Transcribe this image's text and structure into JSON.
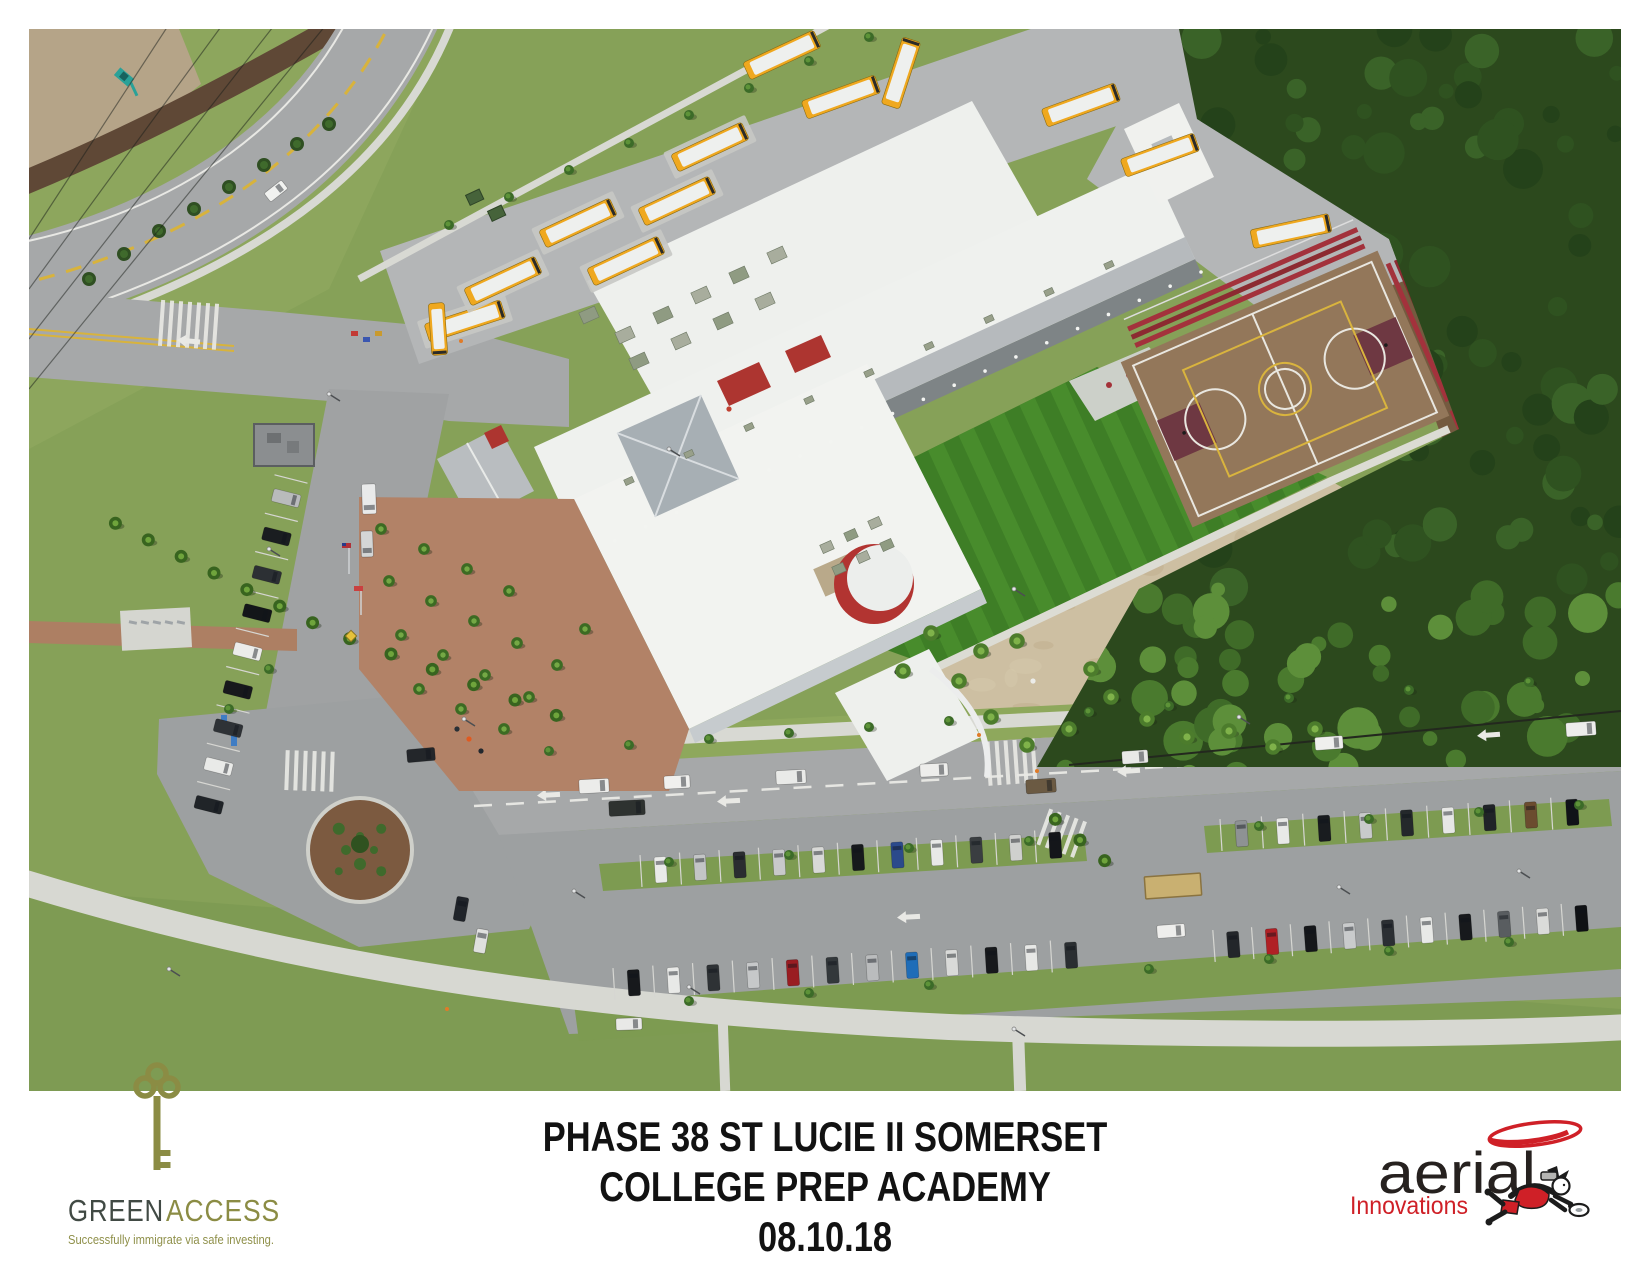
{
  "caption": {
    "line1": "PHASE 38 ST LUCIE II SOMERSET",
    "line2": "COLLEGE PREP ACADEMY",
    "line3": "08.10.18"
  },
  "logos": {
    "greenaccess": {
      "brand_green": "GREEN",
      "brand_access": "ACCESS",
      "tagline": "Successfully immigrate via safe investing.",
      "key_icon": "key-icon",
      "color_dark": "#414a44",
      "color_olive": "#8b8c44",
      "color_tagline": "#8f904a"
    },
    "aerial_innovations": {
      "name": "aerial",
      "sub": "Innovations",
      "swoosh_icon": "swoosh-icon",
      "figure_icon": "flying-photographer-icon",
      "color_red": "#cf2027",
      "color_black": "#26211f"
    }
  },
  "scene": {
    "description": "aerial photograph of school campus with bus loop, buildings, turf field, basketball court, forest and parking lots",
    "colors": {
      "grass": "#86a158",
      "grassLight": "#93ac62",
      "grassDark": "#7a9750",
      "road": "#a6a8a9",
      "lot": "#9da0a1",
      "loop": "#b4b6b7",
      "concrete": "#d8d9d3",
      "sand": "#cdbfa2",
      "dirt": "#8a6f4c",
      "mulch": "#5f4836",
      "forest": "#2c491d",
      "turf": "#3e7e26",
      "turfStripe": "#4a8e2e",
      "court": "#93775a",
      "courtKey": "#6e3842",
      "bleacher": "#a3323c",
      "roofWhite": "#eff1ee",
      "roofGray": "#b6babd",
      "wall": "#c6cbce",
      "shadow": "#7e8486",
      "red": "#ad3530",
      "busYellow": "#efa81f",
      "brick": "#b28267",
      "pond": "#161f12"
    },
    "buses": [
      [
        436,
        292,
        -18,
        80,
        1
      ],
      [
        474,
        252,
        -25,
        78,
        1
      ],
      [
        549,
        194,
        -25,
        78,
        1
      ],
      [
        597,
        232,
        -25,
        78,
        1
      ],
      [
        648,
        172,
        -25,
        78,
        1
      ],
      [
        681,
        118,
        -25,
        78,
        1
      ],
      [
        753,
        26,
        -25,
        78,
        0
      ],
      [
        812,
        68,
        -20,
        78,
        0
      ],
      [
        872,
        44,
        -72,
        70,
        0
      ],
      [
        1052,
        76,
        -20,
        78,
        0
      ],
      [
        1131,
        126,
        -20,
        78,
        0
      ],
      [
        1262,
        202,
        -12,
        80,
        0
      ],
      [
        409,
        300,
        86,
        52,
        0
      ]
    ],
    "car_rows": [
      {
        "x1": 612,
        "y1": 842,
        "x2": 1046,
        "y2": 815,
        "n": 11,
        "len": 26,
        "wid": 12,
        "colors": [
          "#e9eae8",
          "#c3c5c6",
          "#2a2d30",
          "#c8c9ca",
          "#d8d9d7",
          "#16191c",
          "#2b4a8b",
          "#e8e9e7",
          "#3a3e41",
          "#cfd0ce",
          "#14161a"
        ]
      },
      {
        "x1": 1192,
        "y1": 806,
        "x2": 1564,
        "y2": 782,
        "n": 9,
        "len": 26,
        "wid": 12,
        "colors": [
          "#8e9294",
          "#e8e9e7",
          "#191c1f",
          "#c8cacb",
          "#24282b",
          "#e6e7e5",
          "#202328",
          "#6b4c2f",
          "#101318"
        ]
      },
      {
        "x1": 585,
        "y1": 955,
        "x2": 1062,
        "y2": 925,
        "n": 12,
        "len": 26,
        "wid": 12,
        "colors": [
          "#17191c",
          "#e8e9e7",
          "#2e3235",
          "#c6c8c9",
          "#9a1d22",
          "#33383b",
          "#babcbd",
          "#1f6db8",
          "#d9dad8",
          "#17191c",
          "#e7e8e6",
          "#2a2e31"
        ]
      },
      {
        "x1": 1185,
        "y1": 917,
        "x2": 1572,
        "y2": 888,
        "n": 10,
        "len": 26,
        "wid": 12,
        "colors": [
          "#23262a",
          "#b02025",
          "#15171a",
          "#c9cbcc",
          "#2b2f33",
          "#e8e9e7",
          "#17191c",
          "#595d60",
          "#dadbd9",
          "#101215"
        ]
      },
      {
        "x1": 262,
        "y1": 450,
        "x2": 175,
        "y2": 795,
        "n": 9,
        "len": 28,
        "wid": 13,
        "colors": [
          "#b9bbbc",
          "#1a1d20",
          "#2c3034",
          "#131619",
          "#ececea",
          "#17191c",
          "#2e3236",
          "#e9eae8",
          "#202428"
        ]
      }
    ],
    "vehicles": [
      [
        565,
        757,
        -3,
        30,
        14,
        "#ececea"
      ],
      [
        648,
        753,
        -3,
        26,
        13,
        "#f0f0ee"
      ],
      [
        762,
        748,
        -3,
        30,
        14,
        "#e9eae8"
      ],
      [
        598,
        779,
        -3,
        36,
        15,
        "#2e3230"
      ],
      [
        905,
        741,
        -3,
        28,
        13,
        "#ededeb"
      ],
      [
        1012,
        757,
        -4,
        30,
        14,
        "#6b5a43"
      ],
      [
        1106,
        728,
        -4,
        26,
        13,
        "#e9e9e7"
      ],
      [
        1300,
        714,
        -4,
        28,
        13,
        "#efefed"
      ],
      [
        1552,
        700,
        -4,
        30,
        14,
        "#ededeb"
      ],
      [
        392,
        726,
        -5,
        28,
        13,
        "#23262a"
      ],
      [
        340,
        470,
        88,
        30,
        14,
        "#e9eaea"
      ],
      [
        338,
        515,
        88,
        26,
        12,
        "#d4d6d6"
      ],
      [
        247,
        162,
        -38,
        22,
        11,
        "#f1f2f0"
      ],
      [
        1142,
        902,
        -4,
        28,
        13,
        "#eeeeec"
      ],
      [
        600,
        995,
        -2,
        26,
        12,
        "#e9e9e7"
      ],
      [
        432,
        880,
        -80,
        24,
        12,
        "#20242a"
      ],
      [
        452,
        912,
        -80,
        24,
        12,
        "#dfe0de"
      ]
    ],
    "palm_rows": [
      {
        "x1": 70,
        "y1": 486,
        "x2": 300,
        "y2": 602,
        "n": 7
      },
      {
        "x1": 300,
        "y1": 602,
        "x2": 548,
        "y2": 694,
        "n": 6
      },
      {
        "x1": 1014,
        "y1": 780,
        "x2": 1088,
        "y2": 842,
        "n": 3
      }
    ],
    "courtyard_palms": [
      [
        352,
        500
      ],
      [
        395,
        520
      ],
      [
        438,
        540
      ],
      [
        480,
        562
      ],
      [
        360,
        552
      ],
      [
        402,
        572
      ],
      [
        445,
        592
      ],
      [
        488,
        614
      ],
      [
        372,
        606
      ],
      [
        414,
        626
      ],
      [
        456,
        646
      ],
      [
        500,
        668
      ],
      [
        390,
        660
      ],
      [
        432,
        680
      ],
      [
        475,
        700
      ],
      [
        528,
        636
      ],
      [
        556,
        600
      ]
    ],
    "sand_palms": [
      [
        930,
        652
      ],
      [
        962,
        688
      ],
      [
        998,
        716
      ],
      [
        1040,
        700
      ],
      [
        1082,
        668
      ],
      [
        952,
        622
      ],
      [
        1118,
        690
      ],
      [
        1158,
        708
      ],
      [
        902,
        604
      ],
      [
        1200,
        702
      ],
      [
        1244,
        718
      ],
      [
        1286,
        700
      ],
      [
        988,
        612
      ],
      [
        1062,
        640
      ],
      [
        874,
        642
      ]
    ],
    "bushes": [
      [
        60,
        250
      ],
      [
        95,
        225
      ],
      [
        130,
        202
      ],
      [
        165,
        180
      ],
      [
        200,
        158
      ],
      [
        235,
        136
      ],
      [
        268,
        115
      ],
      [
        300,
        95
      ]
    ],
    "trees": [
      [
        420,
        196
      ],
      [
        480,
        168
      ],
      [
        540,
        141
      ],
      [
        600,
        114
      ],
      [
        660,
        86
      ],
      [
        720,
        59
      ],
      [
        780,
        32
      ],
      [
        840,
        8
      ],
      [
        520,
        722
      ],
      [
        600,
        716
      ],
      [
        680,
        710
      ],
      [
        760,
        704
      ],
      [
        840,
        698
      ],
      [
        920,
        692
      ],
      [
        1060,
        683
      ],
      [
        1140,
        677
      ],
      [
        1260,
        669
      ],
      [
        1380,
        661
      ],
      [
        1500,
        653
      ],
      [
        640,
        833
      ],
      [
        760,
        826
      ],
      [
        880,
        819
      ],
      [
        1000,
        812
      ],
      [
        1230,
        797
      ],
      [
        1340,
        790
      ],
      [
        1450,
        783
      ],
      [
        1550,
        776
      ],
      [
        660,
        972
      ],
      [
        780,
        964
      ],
      [
        900,
        956
      ],
      [
        1120,
        940
      ],
      [
        1240,
        930
      ],
      [
        1360,
        922
      ],
      [
        1480,
        913
      ],
      [
        240,
        640
      ],
      [
        200,
        680
      ]
    ],
    "arrows": [
      [
        700,
        772,
        -3
      ],
      [
        1100,
        742,
        -4
      ],
      [
        1460,
        706,
        -4
      ],
      [
        880,
        888,
        -3
      ],
      [
        520,
        766,
        -3
      ],
      [
        160,
        312,
        5
      ]
    ],
    "crosswalks": [
      [
        162,
        296,
        4,
        7,
        46
      ],
      [
        283,
        742,
        2,
        6,
        40
      ],
      [
        985,
        733,
        -4,
        6,
        44
      ],
      [
        1035,
        805,
        20,
        5,
        38
      ]
    ],
    "ac_upper": [
      [
        596,
        306
      ],
      [
        634,
        286
      ],
      [
        672,
        266
      ],
      [
        710,
        246
      ],
      [
        748,
        226
      ],
      [
        610,
        332
      ],
      [
        652,
        312
      ],
      [
        694,
        292
      ],
      [
        736,
        272
      ],
      [
        560,
        286
      ]
    ],
    "ac_ridge": [
      [
        600,
        452
      ],
      [
        660,
        425
      ],
      [
        720,
        398
      ],
      [
        780,
        371
      ],
      [
        840,
        344
      ],
      [
        900,
        317
      ],
      [
        960,
        290
      ],
      [
        1020,
        263
      ],
      [
        1080,
        236
      ]
    ],
    "ac_front": [
      [
        798,
        518
      ],
      [
        822,
        506
      ],
      [
        846,
        494
      ],
      [
        810,
        540
      ],
      [
        834,
        528
      ],
      [
        858,
        516
      ]
    ],
    "people": [
      [
        440,
        710,
        "#e05a20"
      ],
      [
        452,
        722,
        "#23282e"
      ],
      [
        428,
        700,
        "#2a3036"
      ],
      [
        1004,
        652,
        "#ecece9"
      ],
      [
        868,
        643,
        "#1e2228"
      ],
      [
        700,
        380,
        "#c04030"
      ]
    ],
    "lightpoles": [
      [
        435,
        690
      ],
      [
        640,
        420
      ],
      [
        545,
        862
      ],
      [
        985,
        560
      ],
      [
        1210,
        688
      ],
      [
        300,
        365
      ],
      [
        660,
        958
      ],
      [
        1310,
        858
      ],
      [
        1490,
        842
      ],
      [
        240,
        520
      ],
      [
        985,
        1000
      ],
      [
        140,
        940
      ]
    ],
    "cones": [
      [
        432,
        312
      ],
      [
        950,
        706
      ],
      [
        418,
        980
      ],
      [
        1008,
        742
      ]
    ]
  }
}
